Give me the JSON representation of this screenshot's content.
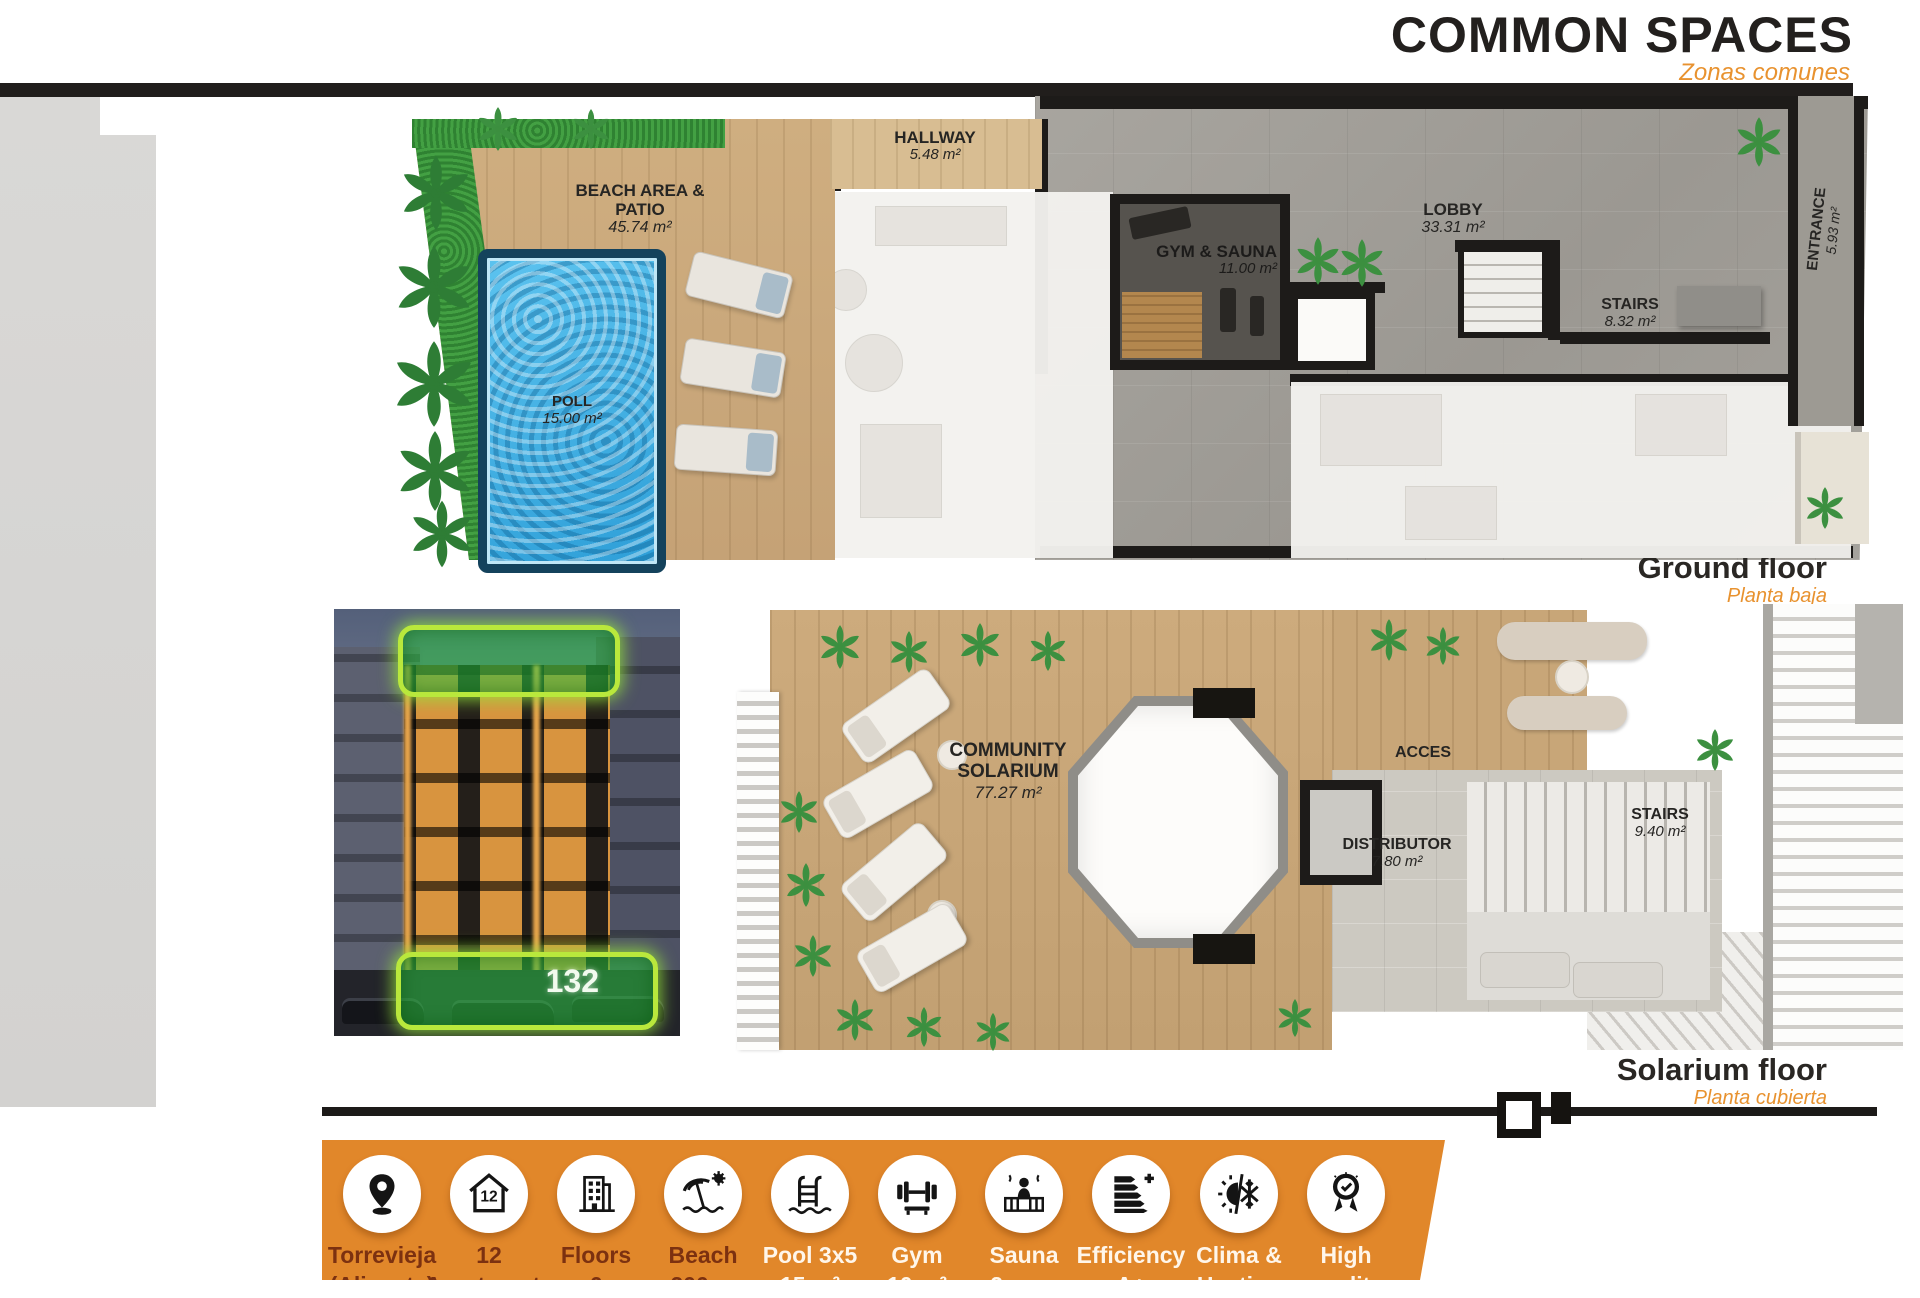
{
  "header": {
    "title": "COMMON SPACES",
    "subtitle": "Zonas comunes"
  },
  "ground": {
    "caption": "Ground floor",
    "caption_es": "Planta baja",
    "beach": {
      "name": "BEACH AREA & PATIO",
      "area": "45.74 m²"
    },
    "pool": {
      "name": "POLL",
      "area": "15.00 m²"
    },
    "hallway": {
      "name": "HALLWAY",
      "area": "5.48 m²"
    },
    "gym": {
      "name": "GYM & SAUNA",
      "area": "11.00 m²"
    },
    "lobby": {
      "name": "LOBBY",
      "area": "33.31 m²"
    },
    "stairs": {
      "name": "STAIRS",
      "area": "8.32 m²"
    },
    "entrance": {
      "name": "ENTRANCE",
      "area": "5.93 m²"
    }
  },
  "solarium": {
    "caption": "Solarium floor",
    "caption_es": "Planta cubierta",
    "community": {
      "name1": "COMMUNITY",
      "name2": "SOLARIUM",
      "area": "77.27 m²"
    },
    "acces": {
      "name": "ACCES"
    },
    "distributor": {
      "name": "DISTRIBUTOR",
      "area": "7.80 m²"
    },
    "stairs": {
      "name": "STAIRS",
      "area": "9.40 m²"
    }
  },
  "photo": {
    "badge": "132"
  },
  "features": [
    {
      "icon": "location-pin-icon",
      "line1": "Torrevieja",
      "line2": "(Alicante)"
    },
    {
      "icon": "house-12-icon",
      "line1": "12",
      "line2": "Apartments"
    },
    {
      "icon": "building-icon",
      "line1": "Floors",
      "line2": "6"
    },
    {
      "icon": "beach-umbrella-icon",
      "line1": "Beach",
      "line2": "200 m"
    },
    {
      "icon": "pool-ladder-icon",
      "line1": "Pool 3x5",
      "line2": "15 m²"
    },
    {
      "icon": "gym-icon",
      "line1": "Gym",
      "line2": "10 m²"
    },
    {
      "icon": "sauna-icon",
      "line1": "Sauna",
      "line2": "2 pers"
    },
    {
      "icon": "efficiency-icon",
      "line1": "Efficiency",
      "line2": "A+"
    },
    {
      "icon": "climate-icon",
      "line1": "Clima &",
      "line2": "Heating"
    },
    {
      "icon": "quality-icon",
      "line1": "High",
      "line2": "quality"
    }
  ],
  "colors": {
    "accent": "#E8922F",
    "bar": "#E1872A",
    "label_dark": "#7C3110",
    "label_light": "#FFF6EA",
    "pool_water": "#45B7E8",
    "grass": "#3F9B3F",
    "wood": "#C9A87C"
  }
}
